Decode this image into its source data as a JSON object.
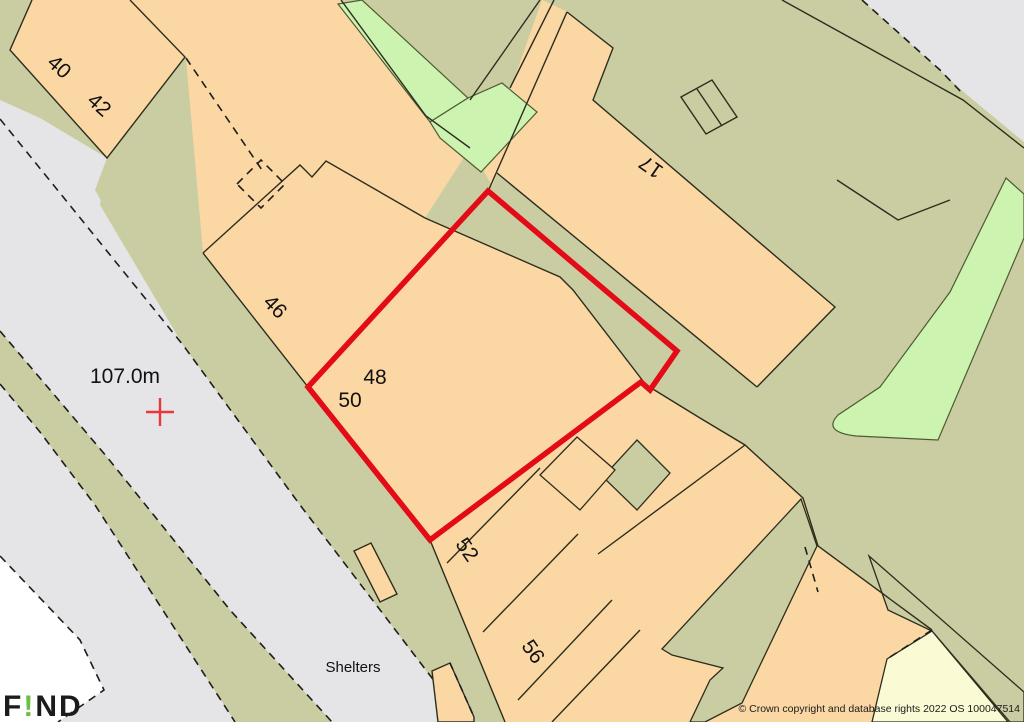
{
  "map": {
    "labels": {
      "n40": "40",
      "n42": "42",
      "n46": "46",
      "n48": "48",
      "n50": "50",
      "n52": "52",
      "n56": "56",
      "n17": "17",
      "spot_height": "107.0m",
      "shelters": "Shelters"
    },
    "watermark": {
      "prefix": "F",
      "exclaim": "!",
      "suffix": "ND"
    },
    "copyright": "© Crown copyright and database rights 2022 OS 100047514",
    "colors": {
      "base_olive": "#CACDA2",
      "road_gray": "#E5E5E7",
      "building_orange": "#FBD7A4",
      "vegetation_green": "#CCF3AF",
      "pale_yellow": "#FAFAD4",
      "line_black": "#2D2D1E",
      "green_edge": "#4F5B33",
      "boundary_red": "#E30B17",
      "watermark_green": "#6CBE45",
      "white_area": "#FFFFFF"
    }
  }
}
